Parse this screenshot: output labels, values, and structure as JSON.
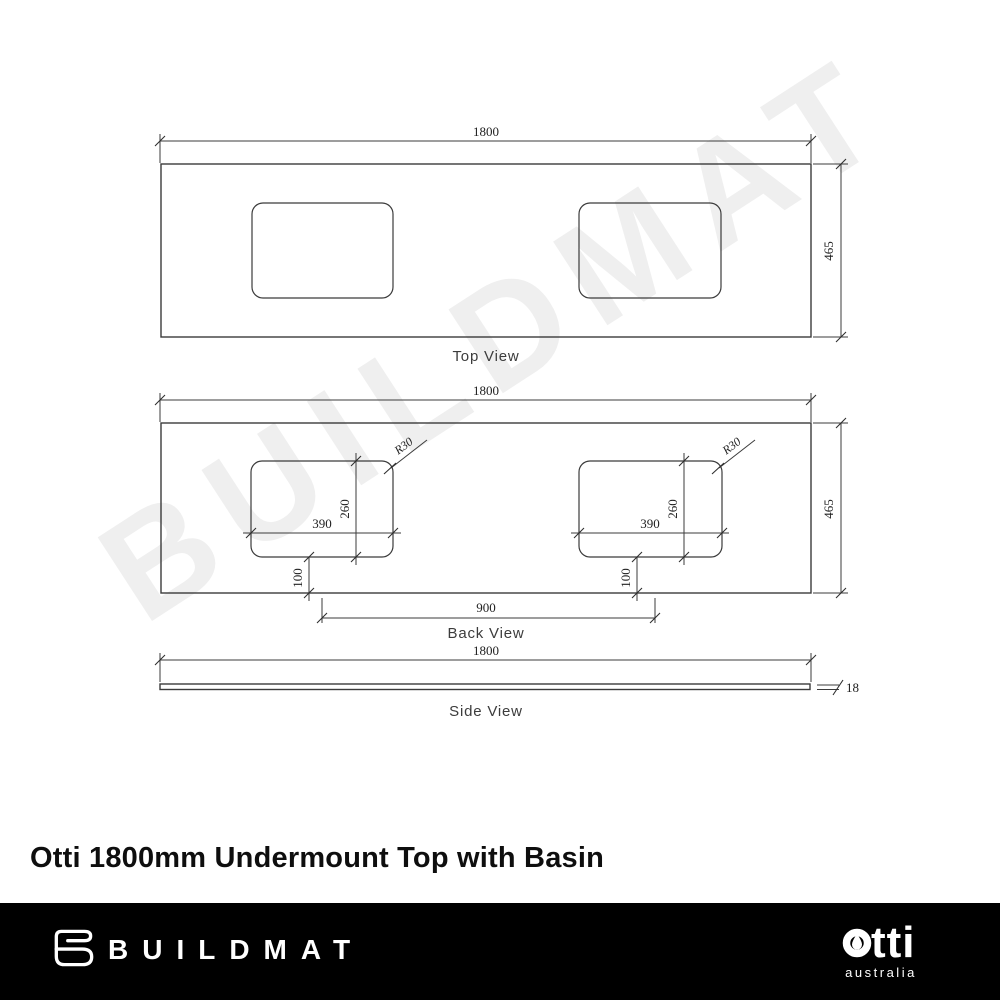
{
  "watermark": {
    "text": "BUILDMAT"
  },
  "drawing": {
    "top_view": {
      "label": "Top View",
      "width": "1800",
      "depth": "465"
    },
    "back_view": {
      "label": "Back View",
      "width": "1800",
      "depth": "465",
      "cutout_width": "390",
      "cutout_depth": "260",
      "corner_radius": "R30",
      "bottom_offset": "100",
      "cutout_spacing": "900"
    },
    "side_view": {
      "label": "Side View",
      "width": "1800",
      "thickness": "18"
    }
  },
  "title": "Otti 1800mm Undermount Top with Basin",
  "footer": {
    "brand": "BUILDMAT",
    "brand_icon": "buildmat-folded-towel-icon",
    "partner_wordmark": "otti",
    "partner_wordmark_text_part": "tti",
    "partner_icon": "otti-droplet-icon",
    "partner_sub": "australia",
    "bg_color": "#000000",
    "text_color": "#ffffff"
  },
  "colors": {
    "line": "#3b3b3b",
    "watermark": "#efefef",
    "background": "#ffffff"
  }
}
